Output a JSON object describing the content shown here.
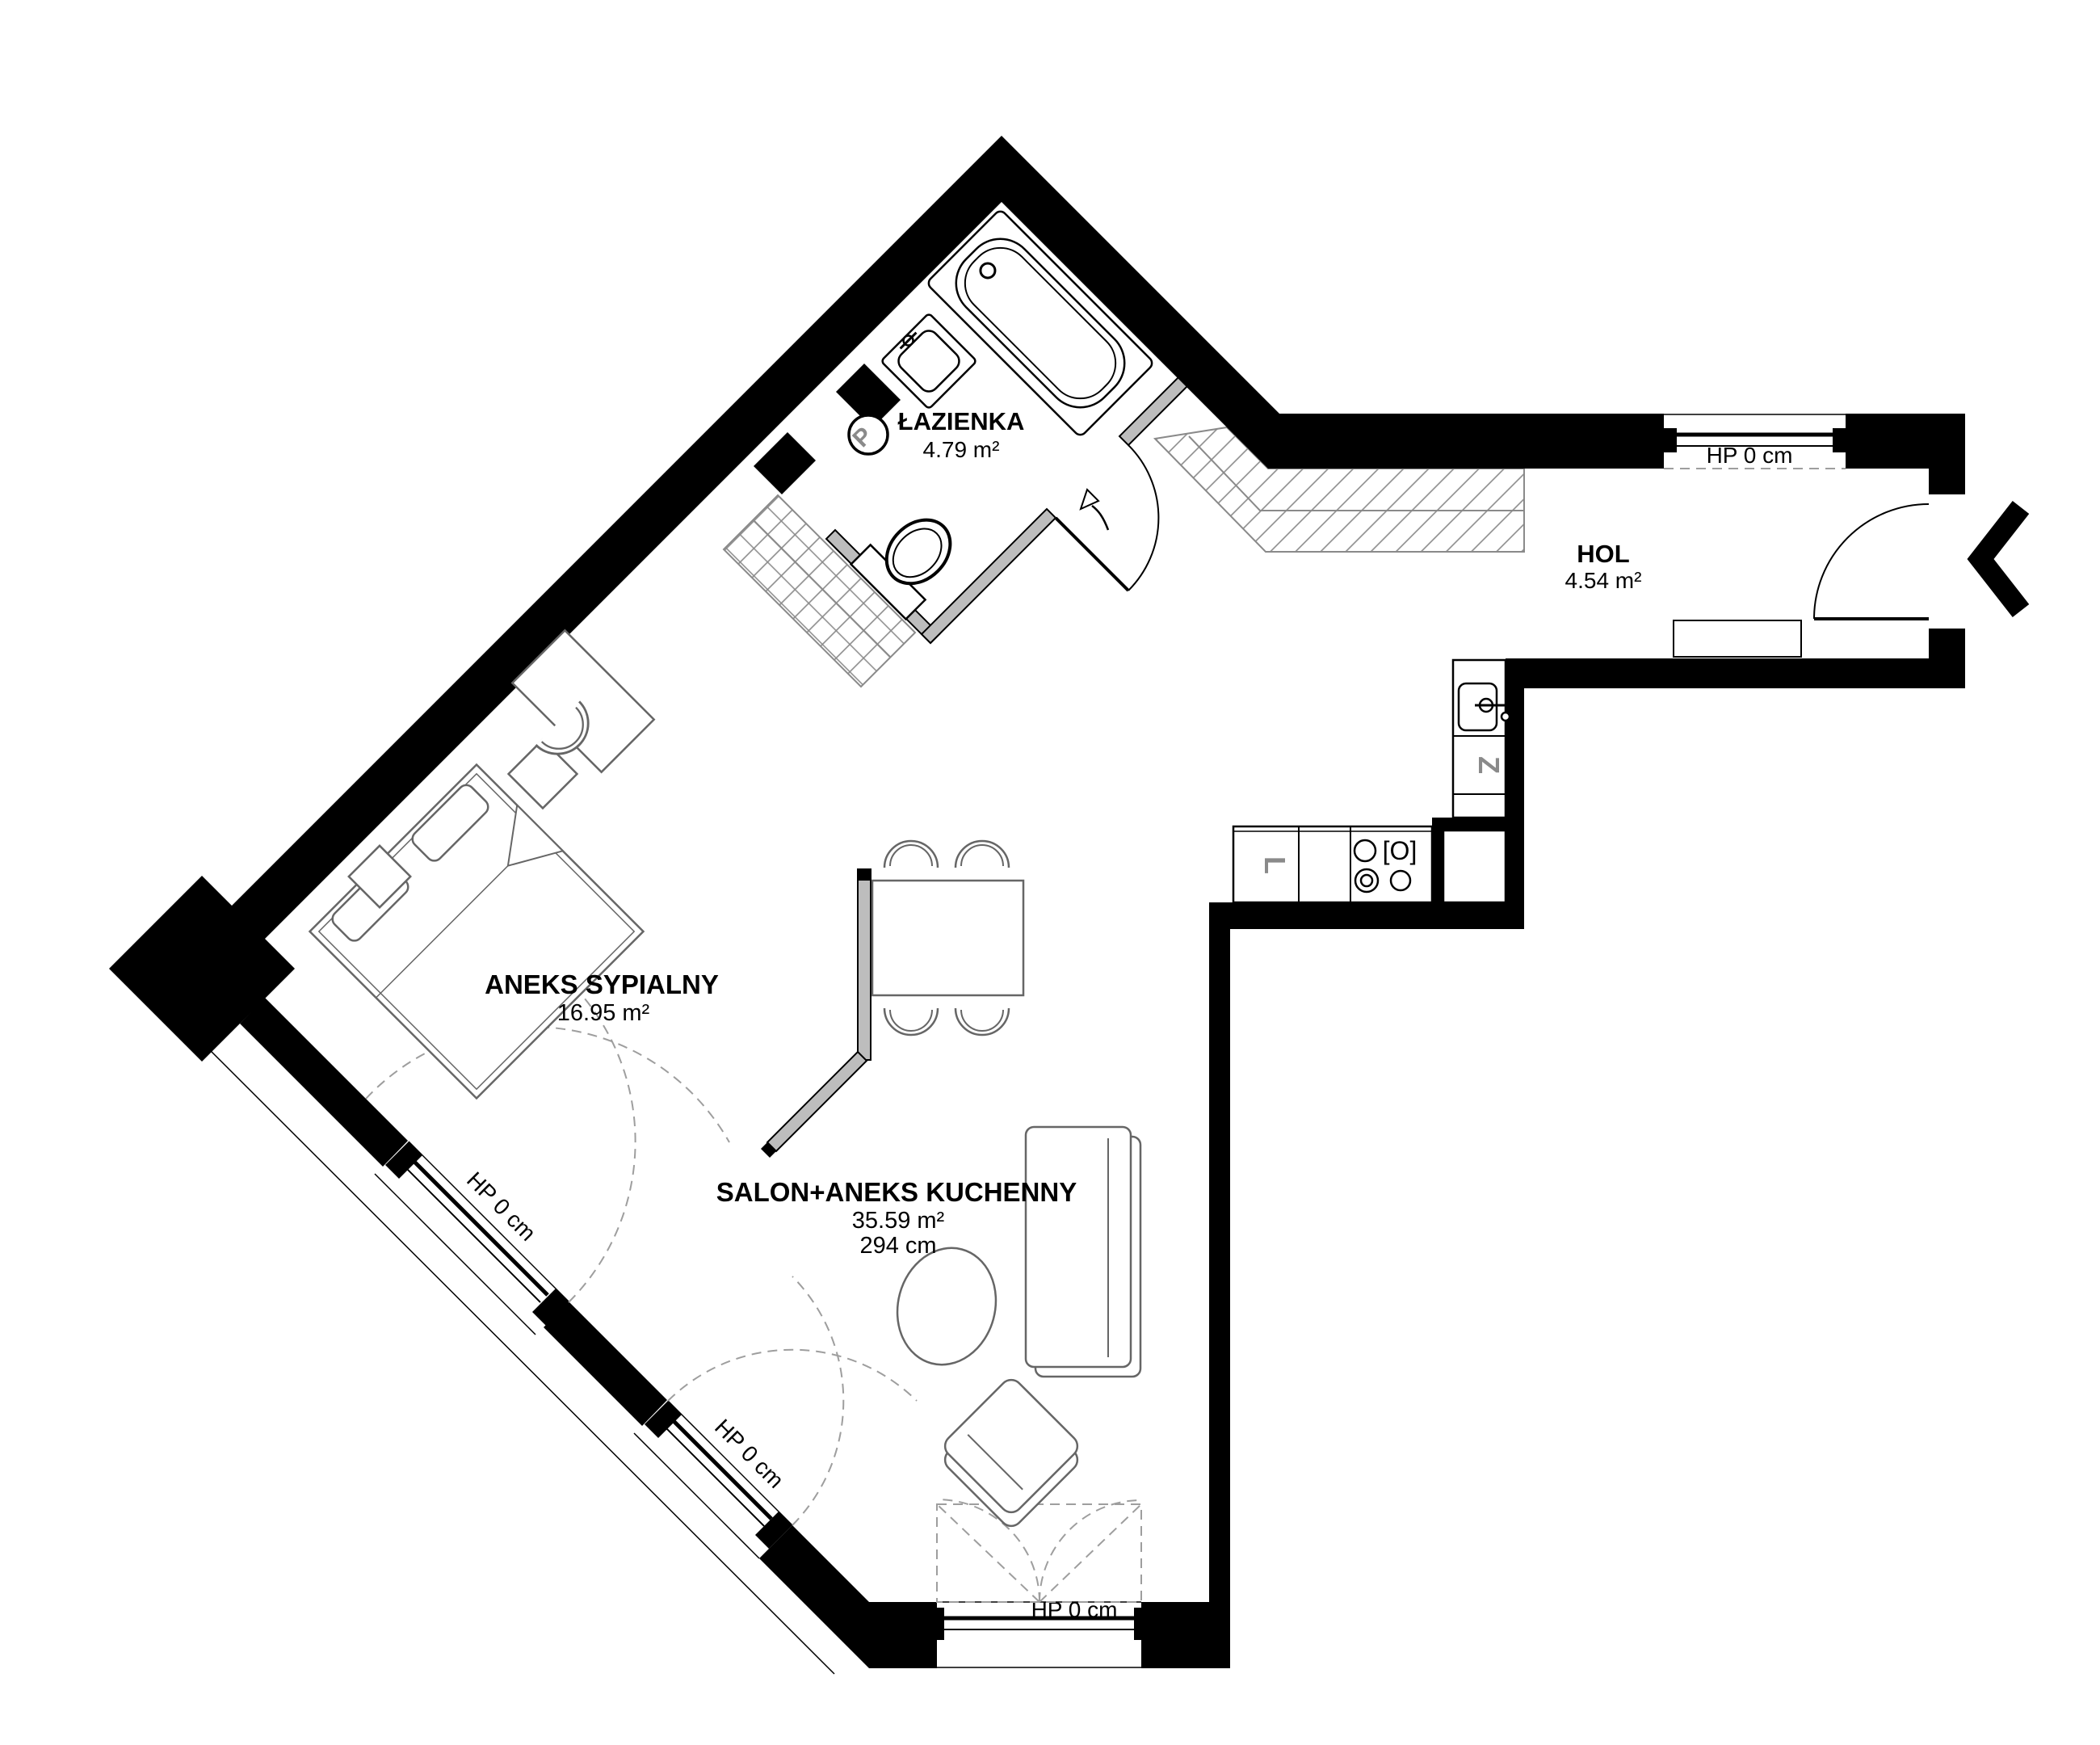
{
  "rooms": {
    "bathroom": {
      "name": "ŁAZIENKA",
      "area": "4.79 m²"
    },
    "hall": {
      "name": "HOL",
      "area": "4.54 m²"
    },
    "bedroom": {
      "name": "ANEKS SYPIALNY",
      "area": "16.95 m²"
    },
    "living": {
      "name": "SALON+ANEKS KUCHENNY",
      "area": "35.59 m²",
      "ceiling": "294 cm"
    }
  },
  "windows": {
    "bedroom_label": "HP 0 cm",
    "living_diag_label": "HP 0 cm",
    "living_bottom_label": "HP 0 cm",
    "hall_label": "HP 0 cm"
  },
  "appliances": {
    "washer": "P",
    "dishwasher": "Z",
    "fridge": "L",
    "oven": "[O]"
  },
  "colors": {
    "walls": "#000000",
    "partitions": "#bdbdbd",
    "hatching": "#8a8a8a",
    "openings_dashed": "#9e9e9e"
  }
}
